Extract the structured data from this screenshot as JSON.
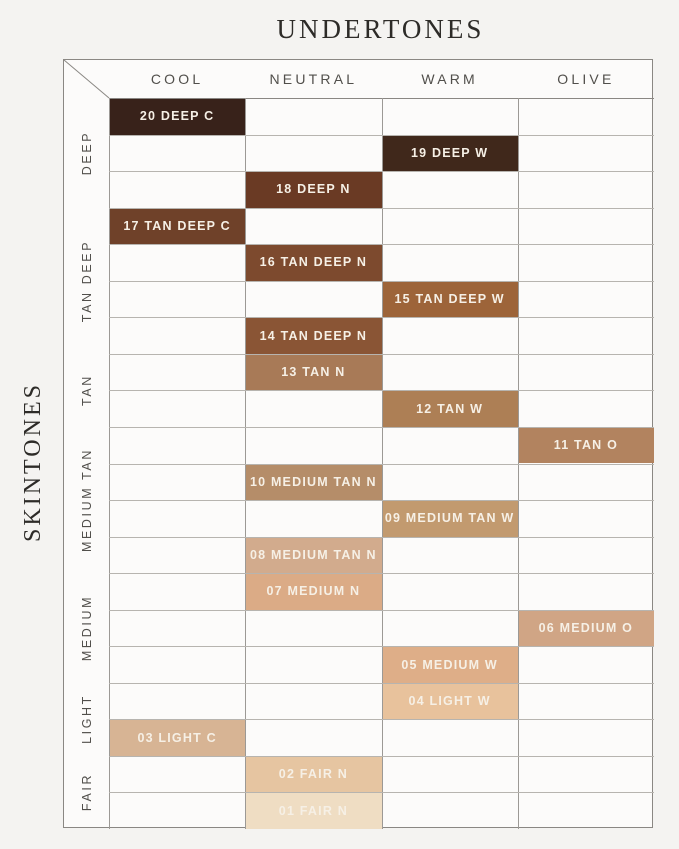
{
  "title": "UNDERTONES",
  "side_title": "SKINTONES",
  "chart_data": {
    "type": "table",
    "title": "UNDERTONES",
    "col_axis_label": "UNDERTONES",
    "row_axis_label": "SKINTONES",
    "columns": [
      "COOL",
      "NEUTRAL",
      "WARM",
      "OLIVE"
    ],
    "row_groups": [
      {
        "label": "DEEP",
        "row_start": 0,
        "row_end": 2
      },
      {
        "label": "TAN DEEP",
        "row_start": 3,
        "row_end": 6
      },
      {
        "label": "TAN",
        "row_start": 7,
        "row_end": 8
      },
      {
        "label": "MEDIUM TAN",
        "row_start": 9,
        "row_end": 12
      },
      {
        "label": "MEDIUM",
        "row_start": 13,
        "row_end": 15
      },
      {
        "label": "LIGHT",
        "row_start": 16,
        "row_end": 17
      },
      {
        "label": "FAIR",
        "row_start": 18,
        "row_end": 19
      }
    ],
    "cells": [
      {
        "row": 0,
        "column": "COOL",
        "label": "20 DEEP C",
        "color": "#38221a"
      },
      {
        "row": 1,
        "column": "WARM",
        "label": "19 DEEP W",
        "color": "#40281b"
      },
      {
        "row": 2,
        "column": "NEUTRAL",
        "label": "18 DEEP N",
        "color": "#6a3a24"
      },
      {
        "row": 3,
        "column": "COOL",
        "label": "17 TAN DEEP C",
        "color": "#6f4129"
      },
      {
        "row": 4,
        "column": "NEUTRAL",
        "label": "16 TAN DEEP N",
        "color": "#7d4a2e"
      },
      {
        "row": 5,
        "column": "WARM",
        "label": "15 TAN DEEP W",
        "color": "#9d6439"
      },
      {
        "row": 6,
        "column": "NEUTRAL",
        "label": "14 TAN DEEP N",
        "color": "#8a5535"
      },
      {
        "row": 7,
        "column": "NEUTRAL",
        "label": "13 TAN N",
        "color": "#a87a57"
      },
      {
        "row": 8,
        "column": "WARM",
        "label": "12 TAN W",
        "color": "#ad7f55"
      },
      {
        "row": 9,
        "column": "OLIVE",
        "label": "11 TAN O",
        "color": "#b2835f"
      },
      {
        "row": 10,
        "column": "NEUTRAL",
        "label": "10 MEDIUM TAN N",
        "color": "#b58d69"
      },
      {
        "row": 11,
        "column": "WARM",
        "label": "09 MEDIUM TAN W",
        "color": "#c29a6f"
      },
      {
        "row": 12,
        "column": "NEUTRAL",
        "label": "08 MEDIUM TAN N",
        "color": "#d2ab8d"
      },
      {
        "row": 13,
        "column": "NEUTRAL",
        "label": "07 MEDIUM N",
        "color": "#dbab86"
      },
      {
        "row": 14,
        "column": "OLIVE",
        "label": "06 MEDIUM O",
        "color": "#d0a585"
      },
      {
        "row": 15,
        "column": "WARM",
        "label": "05 MEDIUM W",
        "color": "#deae88"
      },
      {
        "row": 16,
        "column": "WARM",
        "label": "04 LIGHT W",
        "color": "#e8c29c"
      },
      {
        "row": 17,
        "column": "COOL",
        "label": "03 LIGHT C",
        "color": "#d7b494"
      },
      {
        "row": 18,
        "column": "NEUTRAL",
        "label": "02 FAIR N",
        "color": "#e6c5a1"
      },
      {
        "row": 19,
        "column": "NEUTRAL",
        "label": "01 FAIR N",
        "color": "#efddc3"
      }
    ]
  },
  "colors": {
    "page_background": "#f4f3f1",
    "table_background": "#fcfbfa",
    "row_line": "#b7b4af",
    "column_line": "#9c9995",
    "outer_border": "#8a8783",
    "header_text": "#514f4b",
    "title_text": "#2d2b28",
    "cell_text": "#f6f0e6"
  }
}
